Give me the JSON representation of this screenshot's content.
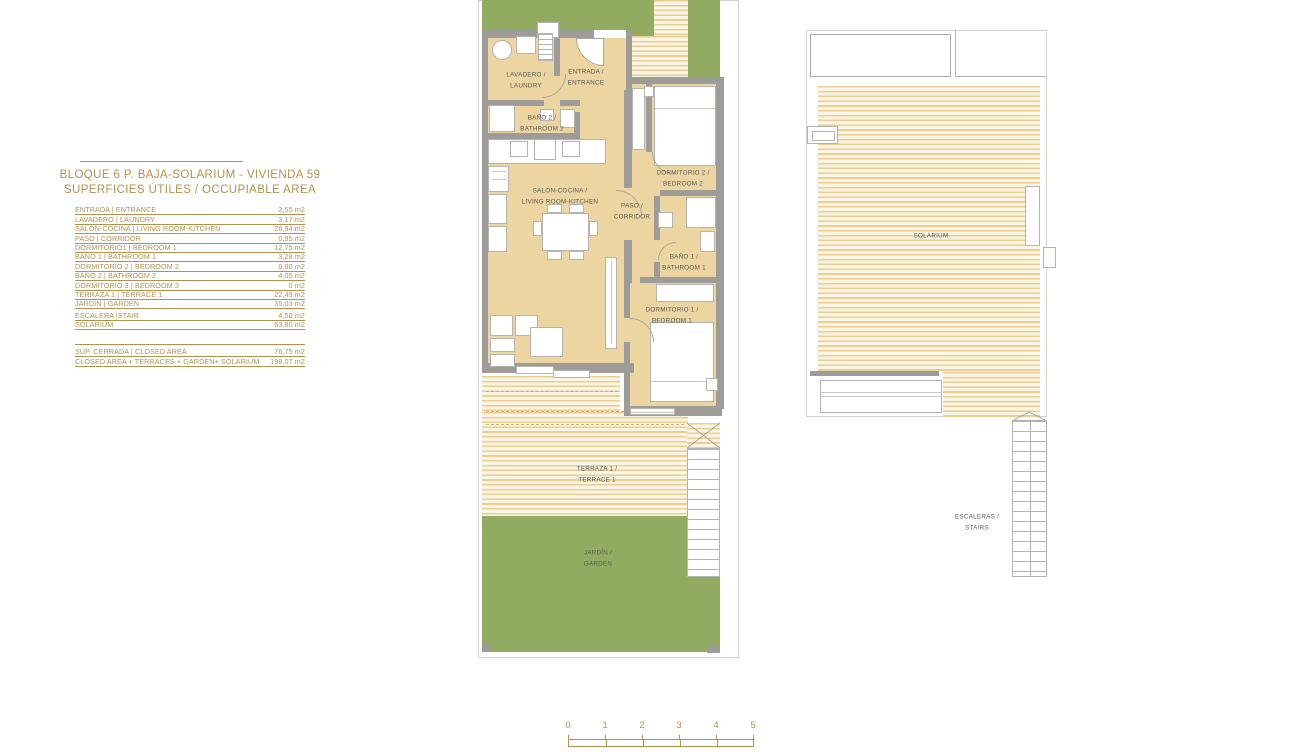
{
  "panel": {
    "title_line1": "BLOQUE 6 P. BAJA-SOLARIUM - VIVIENDA 59",
    "title_line2": "SUPERFICIES ÚTILES / OCCUPIABLE AREA",
    "rows": [
      {
        "label": "ENTRADA | ENTRANCE",
        "value": "2,55 m2"
      },
      {
        "label": "LAVADERO | LAUNDRY",
        "value": "3,17 m2"
      },
      {
        "label": "SALÓN-COCINA | LIVING ROOM-KITCHEN",
        "value": "26,94 m2"
      },
      {
        "label": "PASO | CORRIDOR",
        "value": "0,95 m2"
      },
      {
        "label": "DORMITORIO1 | BEDROOM 1",
        "value": "12,75 m2"
      },
      {
        "label": "BAÑO 1 | BATHROOM 1",
        "value": "3,28 m2"
      },
      {
        "label": "DORMITORIO 2 | BEDROOM 2",
        "value": "9,90 m2"
      },
      {
        "label": "BAÑO 2 | BATHROOM 2",
        "value": "4,05 m2"
      },
      {
        "label": "DORMITORIO 3 | BEDROOM 3",
        "value": "0 m2"
      },
      {
        "label": "TERRAZA 1 | TERRACE 1",
        "value": "22,49 m2"
      },
      {
        "label": "JARDÍN | GARDEN",
        "value": "35,03 m2"
      },
      {
        "label": "ESCALERA |STAIR",
        "value": "4,50 m2"
      },
      {
        "label": "SOLARIUM",
        "value": "63,80 m2"
      }
    ],
    "summary_rows": [
      {
        "label": "SUP. CERRADA | CLOSED AREA",
        "value": "76,75 m2"
      },
      {
        "label": "CLOSED AREA + TERRACES + GARDEN+ SOLARIUM",
        "value": "198,07 m2"
      }
    ]
  },
  "plan_main": {
    "rooms": {
      "lavadero": {
        "line1": "LAVADERO /",
        "line2": "LAUNDRY"
      },
      "entrada": {
        "line1": "ENTRADA /",
        "line2": "ENTRANCE"
      },
      "bano2": {
        "line1": "BAÑO 2 /",
        "line2": "BATHROOM 2"
      },
      "salon": {
        "line1": "SALÓN-COCINA /",
        "line2": "LIVING ROOM-KITCHEN"
      },
      "paso": {
        "line1": "PASO /",
        "line2": "CORRIDOR"
      },
      "dormitorio2": {
        "line1": "DORMITORIO 2 /",
        "line2": "BEDROOM 2"
      },
      "bano1": {
        "line1": "BAÑO 1 /",
        "line2": "BATHROOM 1"
      },
      "dormitorio1": {
        "line1": "DORMITORIO 1 /",
        "line2": "BEDROOM 1"
      },
      "terraza": {
        "line1": "TERRAZA 1 /",
        "line2": "TERRACE 1"
      },
      "jardin": {
        "line1": "JARDÍN /",
        "line2": "GARDEN"
      }
    }
  },
  "plan_solarium": {
    "solarium_label": "SOLARIUM",
    "escaleras": {
      "line1": "ESCALERAS /",
      "line2": "STAIRS"
    }
  },
  "scale_bar": {
    "ticks": [
      "0",
      "1",
      "2",
      "3",
      "4",
      "5"
    ]
  },
  "colors": {
    "gold": "#b2914d",
    "garden_green": "#91ab60",
    "room_cream": "#ecd5a0",
    "hatch_tan": "#eccd93",
    "wall_gray": "#9d9c99",
    "label_gray": "#58595b"
  }
}
